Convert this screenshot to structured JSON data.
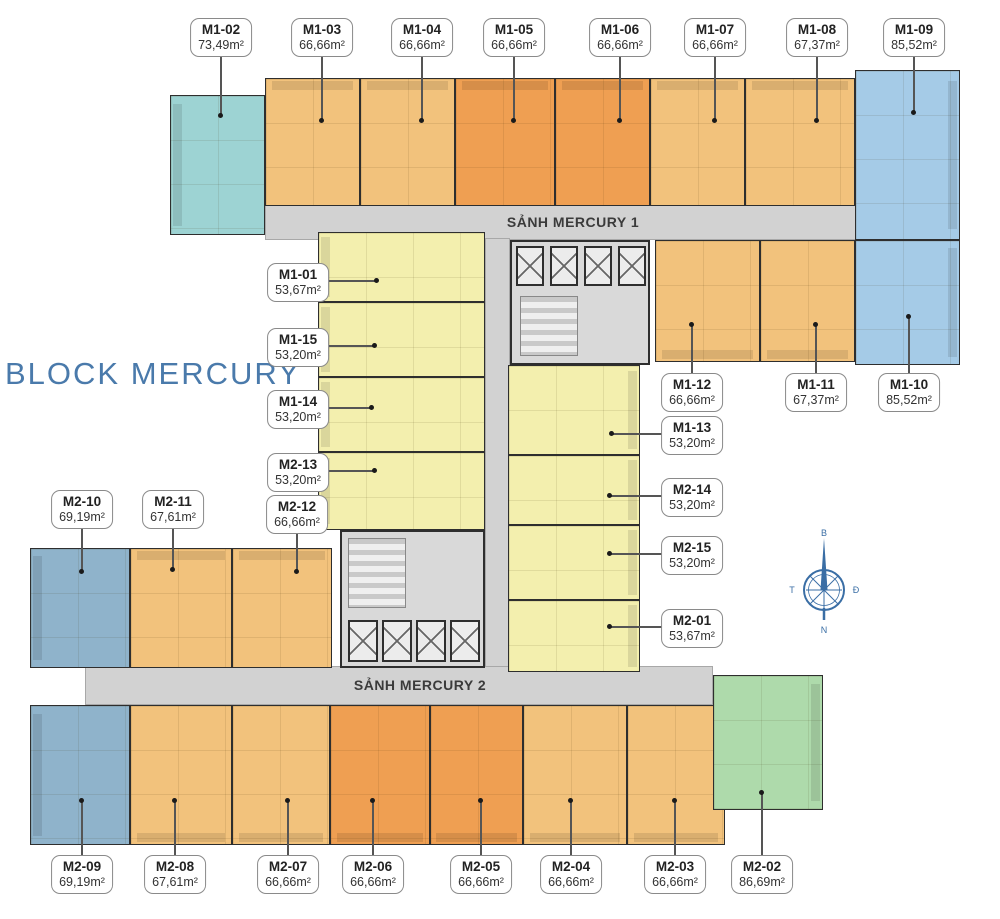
{
  "title": "BLOCK MERCURY",
  "halls": {
    "hall1": "SẢNH MERCURY 1",
    "hall2": "SẢNH MERCURY 2"
  },
  "compass": {
    "north": "B",
    "east": "Đ",
    "south": "N",
    "west": "T"
  },
  "colors": {
    "teal": "#9dd3d3",
    "tan": "#f2c27c",
    "orange": "#ef9f52",
    "blue": "#a5cbe7",
    "bluegray": "#8fb3cb",
    "yellow": "#f3efae",
    "green": "#aedaab",
    "corridor": "#d2d2d2",
    "title_blue": "#4a7aab",
    "compass_blue": "#3a6ea5"
  },
  "units": {
    "m1_01": {
      "code": "M1-01",
      "area": "53,67m²"
    },
    "m1_02": {
      "code": "M1-02",
      "area": "73,49m²"
    },
    "m1_03": {
      "code": "M1-03",
      "area": "66,66m²"
    },
    "m1_04": {
      "code": "M1-04",
      "area": "66,66m²"
    },
    "m1_05": {
      "code": "M1-05",
      "area": "66,66m²"
    },
    "m1_06": {
      "code": "M1-06",
      "area": "66,66m²"
    },
    "m1_07": {
      "code": "M1-07",
      "area": "66,66m²"
    },
    "m1_08": {
      "code": "M1-08",
      "area": "67,37m²"
    },
    "m1_09": {
      "code": "M1-09",
      "area": "85,52m²"
    },
    "m1_10": {
      "code": "M1-10",
      "area": "85,52m²"
    },
    "m1_11": {
      "code": "M1-11",
      "area": "67,37m²"
    },
    "m1_12": {
      "code": "M1-12",
      "area": "66,66m²"
    },
    "m1_13": {
      "code": "M1-13",
      "area": "53,20m²"
    },
    "m1_14": {
      "code": "M1-14",
      "area": "53,20m²"
    },
    "m1_15": {
      "code": "M1-15",
      "area": "53,20m²"
    },
    "m2_01": {
      "code": "M2-01",
      "area": "53,67m²"
    },
    "m2_02": {
      "code": "M2-02",
      "area": "86,69m²"
    },
    "m2_03": {
      "code": "M2-03",
      "area": "66,66m²"
    },
    "m2_04": {
      "code": "M2-04",
      "area": "66,66m²"
    },
    "m2_05": {
      "code": "M2-05",
      "area": "66,66m²"
    },
    "m2_06": {
      "code": "M2-06",
      "area": "66,66m²"
    },
    "m2_07": {
      "code": "M2-07",
      "area": "66,66m²"
    },
    "m2_08": {
      "code": "M2-08",
      "area": "67,61m²"
    },
    "m2_09": {
      "code": "M2-09",
      "area": "69,19m²"
    },
    "m2_10": {
      "code": "M2-10",
      "area": "69,19m²"
    },
    "m2_11": {
      "code": "M2-11",
      "area": "67,61m²"
    },
    "m2_12": {
      "code": "M2-12",
      "area": "66,66m²"
    },
    "m2_13": {
      "code": "M2-13",
      "area": "53,20m²"
    },
    "m2_14": {
      "code": "M2-14",
      "area": "53,20m²"
    },
    "m2_15": {
      "code": "M2-15",
      "area": "53,20m²"
    }
  }
}
